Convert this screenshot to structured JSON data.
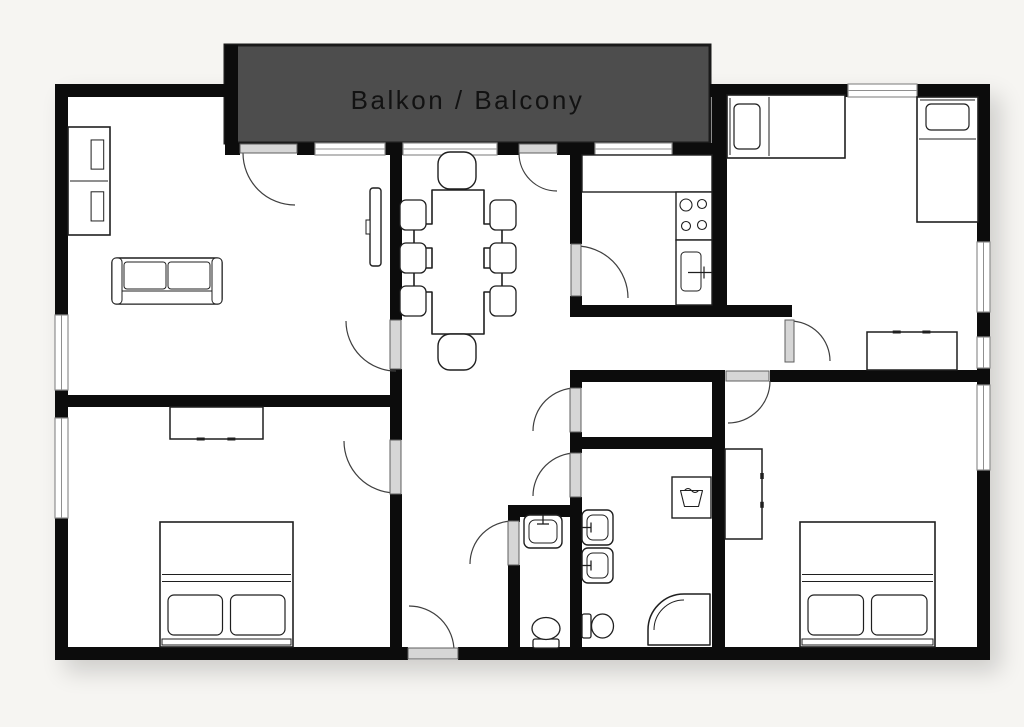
{
  "balcony": {
    "label": "Balkon / Balcony"
  },
  "colors": {
    "background": "#f6f5f2",
    "floor": "#ffffff",
    "wall": "#0c0c0c",
    "balcony_fill": "#4d4d4d",
    "balcony_border": "#1a1a1a",
    "window_stroke": "#8f8f8f",
    "door_leaf_fill": "#d6d6d6",
    "door_leaf_stroke": "#5f5f5f",
    "door_arc": "#3f3f3f",
    "furniture_stroke": "#1f1f1f",
    "label_color": "#121212"
  },
  "floor": {
    "x": 55,
    "y": 84,
    "w": 935,
    "h": 576
  },
  "balcony_deck": {
    "x": 225,
    "y": 45,
    "w": 485,
    "h": 98
  },
  "walls": [
    {
      "x": 55,
      "y": 84,
      "w": 183,
      "h": 13
    },
    {
      "x": 225,
      "y": 45,
      "w": 13,
      "h": 98
    },
    {
      "x": 710,
      "y": 84,
      "w": 138,
      "h": 13
    },
    {
      "x": 917,
      "y": 84,
      "w": 73,
      "h": 13
    },
    {
      "x": 55,
      "y": 84,
      "w": 13,
      "h": 231
    },
    {
      "x": 55,
      "y": 390,
      "w": 13,
      "h": 28
    },
    {
      "x": 55,
      "y": 518,
      "w": 13,
      "h": 142
    },
    {
      "x": 55,
      "y": 647,
      "w": 353,
      "h": 13
    },
    {
      "x": 458,
      "y": 647,
      "w": 532,
      "h": 13
    },
    {
      "x": 977,
      "y": 84,
      "w": 13,
      "h": 158
    },
    {
      "x": 977,
      "y": 312,
      "w": 13,
      "h": 25
    },
    {
      "x": 977,
      "y": 368,
      "w": 13,
      "h": 17
    },
    {
      "x": 977,
      "y": 470,
      "w": 13,
      "h": 190
    },
    {
      "x": 225,
      "y": 143,
      "w": 15,
      "h": 12
    },
    {
      "x": 297,
      "y": 143,
      "w": 18,
      "h": 12
    },
    {
      "x": 385,
      "y": 143,
      "w": 18,
      "h": 12
    },
    {
      "x": 497,
      "y": 143,
      "w": 22,
      "h": 12
    },
    {
      "x": 557,
      "y": 143,
      "w": 38,
      "h": 12
    },
    {
      "x": 672,
      "y": 143,
      "w": 55,
      "h": 12
    },
    {
      "x": 390,
      "y": 155,
      "w": 12,
      "h": 165
    },
    {
      "x": 390,
      "y": 369,
      "w": 12,
      "h": 71
    },
    {
      "x": 390,
      "y": 494,
      "w": 12,
      "h": 153
    },
    {
      "x": 60,
      "y": 395,
      "w": 330,
      "h": 12
    },
    {
      "x": 570,
      "y": 155,
      "w": 12,
      "h": 89
    },
    {
      "x": 570,
      "y": 296,
      "w": 12,
      "h": 21
    },
    {
      "x": 712,
      "y": 84,
      "w": 15,
      "h": 233
    },
    {
      "x": 570,
      "y": 305,
      "w": 222,
      "h": 12
    },
    {
      "x": 570,
      "y": 370,
      "w": 155,
      "h": 12
    },
    {
      "x": 770,
      "y": 370,
      "w": 220,
      "h": 12
    },
    {
      "x": 570,
      "y": 370,
      "w": 12,
      "h": 18
    },
    {
      "x": 570,
      "y": 432,
      "w": 12,
      "h": 21
    },
    {
      "x": 570,
      "y": 437,
      "w": 145,
      "h": 12
    },
    {
      "x": 570,
      "y": 497,
      "w": 12,
      "h": 150
    },
    {
      "x": 712,
      "y": 370,
      "w": 13,
      "h": 277
    },
    {
      "x": 508,
      "y": 505,
      "w": 74,
      "h": 12
    },
    {
      "x": 508,
      "y": 505,
      "w": 12,
      "h": 17
    },
    {
      "x": 508,
      "y": 565,
      "w": 12,
      "h": 82
    }
  ],
  "windows": [
    {
      "x": 55,
      "y": 315,
      "w": 13,
      "h": 75
    },
    {
      "x": 55,
      "y": 418,
      "w": 13,
      "h": 100
    },
    {
      "x": 977,
      "y": 242,
      "w": 13,
      "h": 70
    },
    {
      "x": 977,
      "y": 337,
      "w": 13,
      "h": 31
    },
    {
      "x": 977,
      "y": 385,
      "w": 13,
      "h": 85
    },
    {
      "x": 848,
      "y": 84,
      "w": 69,
      "h": 13
    },
    {
      "x": 315,
      "y": 143,
      "w": 70,
      "h": 12
    },
    {
      "x": 403,
      "y": 143,
      "w": 94,
      "h": 12
    },
    {
      "x": 595,
      "y": 143,
      "w": 77,
      "h": 12
    }
  ],
  "doors": [
    {
      "name": "balcony-door-living",
      "leaf": {
        "x": 240,
        "y": 144,
        "w": 57,
        "h": 9
      },
      "arc": {
        "cx": 295,
        "cy": 153,
        "r": 52,
        "a0": 180,
        "a1": 90
      }
    },
    {
      "name": "balcony-door-dining",
      "leaf": {
        "x": 519,
        "y": 144,
        "w": 38,
        "h": 9
      },
      "arc": {
        "cx": 557,
        "cy": 153,
        "r": 38,
        "a0": 180,
        "a1": 90
      }
    },
    {
      "name": "kitchen-door",
      "leaf": {
        "x": 571,
        "y": 244,
        "w": 10,
        "h": 52
      },
      "arc": {
        "cx": 576,
        "cy": 298,
        "r": 52,
        "a0": 270,
        "a1": 360
      }
    },
    {
      "name": "living-room-door",
      "leaf": {
        "x": 390,
        "y": 320,
        "w": 11,
        "h": 49
      },
      "arc": {
        "cx": 396,
        "cy": 321,
        "r": 50,
        "a0": 180,
        "a1": 90
      }
    },
    {
      "name": "bedroom-bl-door",
      "leaf": {
        "x": 390,
        "y": 440,
        "w": 11,
        "h": 54
      },
      "arc": {
        "cx": 396,
        "cy": 441,
        "r": 52,
        "a0": 180,
        "a1": 90
      }
    },
    {
      "name": "storage-door",
      "leaf": {
        "x": 570,
        "y": 388,
        "w": 11,
        "h": 44
      },
      "arc": {
        "cx": 576,
        "cy": 431,
        "r": 43,
        "a0": 270,
        "a1": 180
      }
    },
    {
      "name": "bathroom-door",
      "leaf": {
        "x": 570,
        "y": 453,
        "w": 11,
        "h": 44
      },
      "arc": {
        "cx": 576,
        "cy": 496,
        "r": 43,
        "a0": 270,
        "a1": 180
      }
    },
    {
      "name": "wc-door",
      "leaf": {
        "x": 508,
        "y": 521,
        "w": 11,
        "h": 44
      },
      "arc": {
        "cx": 513,
        "cy": 564,
        "r": 43,
        "a0": 270,
        "a1": 180
      }
    },
    {
      "name": "entrance-door",
      "leaf": {
        "x": 408,
        "y": 648,
        "w": 50,
        "h": 11
      },
      "arc": {
        "cx": 409,
        "cy": 651,
        "r": 45,
        "a0": 270,
        "a1": 360
      }
    },
    {
      "name": "bedroom-tr-door",
      "leaf": {
        "x": 785,
        "y": 320,
        "w": 9,
        "h": 42
      },
      "arc": {
        "cx": 790,
        "cy": 361,
        "r": 40,
        "a0": 270,
        "a1": 360
      }
    },
    {
      "name": "bedroom-br-door",
      "leaf": {
        "x": 726,
        "y": 371,
        "w": 43,
        "h": 10
      },
      "arc": {
        "cx": 728,
        "cy": 381,
        "r": 42,
        "a0": 0,
        "a1": 90
      }
    }
  ],
  "furniture": [
    {
      "type": "shelf",
      "name": "wall-unit",
      "x": 68,
      "y": 127,
      "w": 42,
      "h": 108
    },
    {
      "type": "sofa",
      "name": "sofa",
      "x": 112,
      "y": 258,
      "w": 110,
      "h": 46
    },
    {
      "type": "tv",
      "name": "tv",
      "x": 370,
      "y": 188,
      "w": 11,
      "h": 78
    },
    {
      "type": "table",
      "name": "dining-table",
      "path": "M432,190 H484 V224 H502 V248 H484 V268 H502 V292 H484 V334 H432 V292 H414 V268 H432 V248 H414 V224 H432 Z"
    },
    {
      "type": "chair_end",
      "name": "dining-chair",
      "x": 438,
      "y": 152,
      "w": 38,
      "h": 37
    },
    {
      "type": "chair_end",
      "name": "dining-chair",
      "x": 438,
      "y": 334,
      "w": 38,
      "h": 36
    },
    {
      "type": "chair",
      "name": "dining-chair",
      "x": 400,
      "y": 200,
      "w": 26,
      "h": 30
    },
    {
      "type": "chair",
      "name": "dining-chair",
      "x": 400,
      "y": 243,
      "w": 26,
      "h": 30
    },
    {
      "type": "chair",
      "name": "dining-chair",
      "x": 400,
      "y": 286,
      "w": 26,
      "h": 30
    },
    {
      "type": "chair",
      "name": "dining-chair",
      "x": 490,
      "y": 200,
      "w": 26,
      "h": 30
    },
    {
      "type": "chair",
      "name": "dining-chair",
      "x": 490,
      "y": 243,
      "w": 26,
      "h": 30
    },
    {
      "type": "chair",
      "name": "dining-chair",
      "x": 490,
      "y": 286,
      "w": 26,
      "h": 30
    },
    {
      "type": "counter",
      "name": "kitchen-counter",
      "x": 582,
      "y": 155,
      "w": 130,
      "h": 37
    },
    {
      "type": "stove",
      "name": "stove",
      "x": 676,
      "y": 192,
      "w": 36,
      "h": 48
    },
    {
      "type": "sink_k",
      "name": "kitchen-sink",
      "x": 676,
      "y": 240,
      "w": 36,
      "h": 65
    },
    {
      "type": "bed_h",
      "name": "bed-single-left",
      "x": 727,
      "y": 95,
      "w": 118,
      "h": 63
    },
    {
      "type": "bed_v",
      "name": "bed-single-right",
      "x": 917,
      "y": 97,
      "w": 61,
      "h": 125
    },
    {
      "type": "dresser",
      "name": "dresser-bedroom-tr",
      "x": 867,
      "y": 332,
      "w": 90,
      "h": 38,
      "handles": "N"
    },
    {
      "type": "dresser",
      "name": "dresser-bedroom-bl",
      "x": 170,
      "y": 407,
      "w": 93,
      "h": 32,
      "handles": "S"
    },
    {
      "type": "bed_d",
      "name": "bed-double-bottom-left",
      "x": 160,
      "y": 522,
      "w": 133,
      "h": 125
    },
    {
      "type": "bed_d",
      "name": "bed-double-bottom-right",
      "x": 800,
      "y": 522,
      "w": 135,
      "h": 125
    },
    {
      "type": "wardrobe",
      "name": "wardrobe",
      "x": 725,
      "y": 449,
      "w": 37,
      "h": 90
    },
    {
      "type": "washer",
      "name": "washing-machine",
      "x": 672,
      "y": 477,
      "w": 39,
      "h": 41
    },
    {
      "type": "sink_b",
      "name": "bathroom-sink-1",
      "x": 582,
      "y": 510,
      "w": 31,
      "h": 35,
      "side": "W"
    },
    {
      "type": "sink_b",
      "name": "bathroom-sink-2",
      "x": 582,
      "y": 548,
      "w": 31,
      "h": 35,
      "side": "W"
    },
    {
      "type": "toilet",
      "name": "bathroom-toilet",
      "x": 582,
      "y": 612,
      "w": 32,
      "h": 28,
      "dir": "E"
    },
    {
      "type": "sink_b",
      "name": "wc-sink",
      "x": 524,
      "y": 515,
      "w": 38,
      "h": 33,
      "side": "N"
    },
    {
      "type": "toilet",
      "name": "wc-toilet",
      "x": 531,
      "y": 616,
      "w": 30,
      "h": 32,
      "dir": "N"
    },
    {
      "type": "shower",
      "name": "shower",
      "x": 648,
      "y": 594,
      "w": 64,
      "h": 53
    }
  ]
}
